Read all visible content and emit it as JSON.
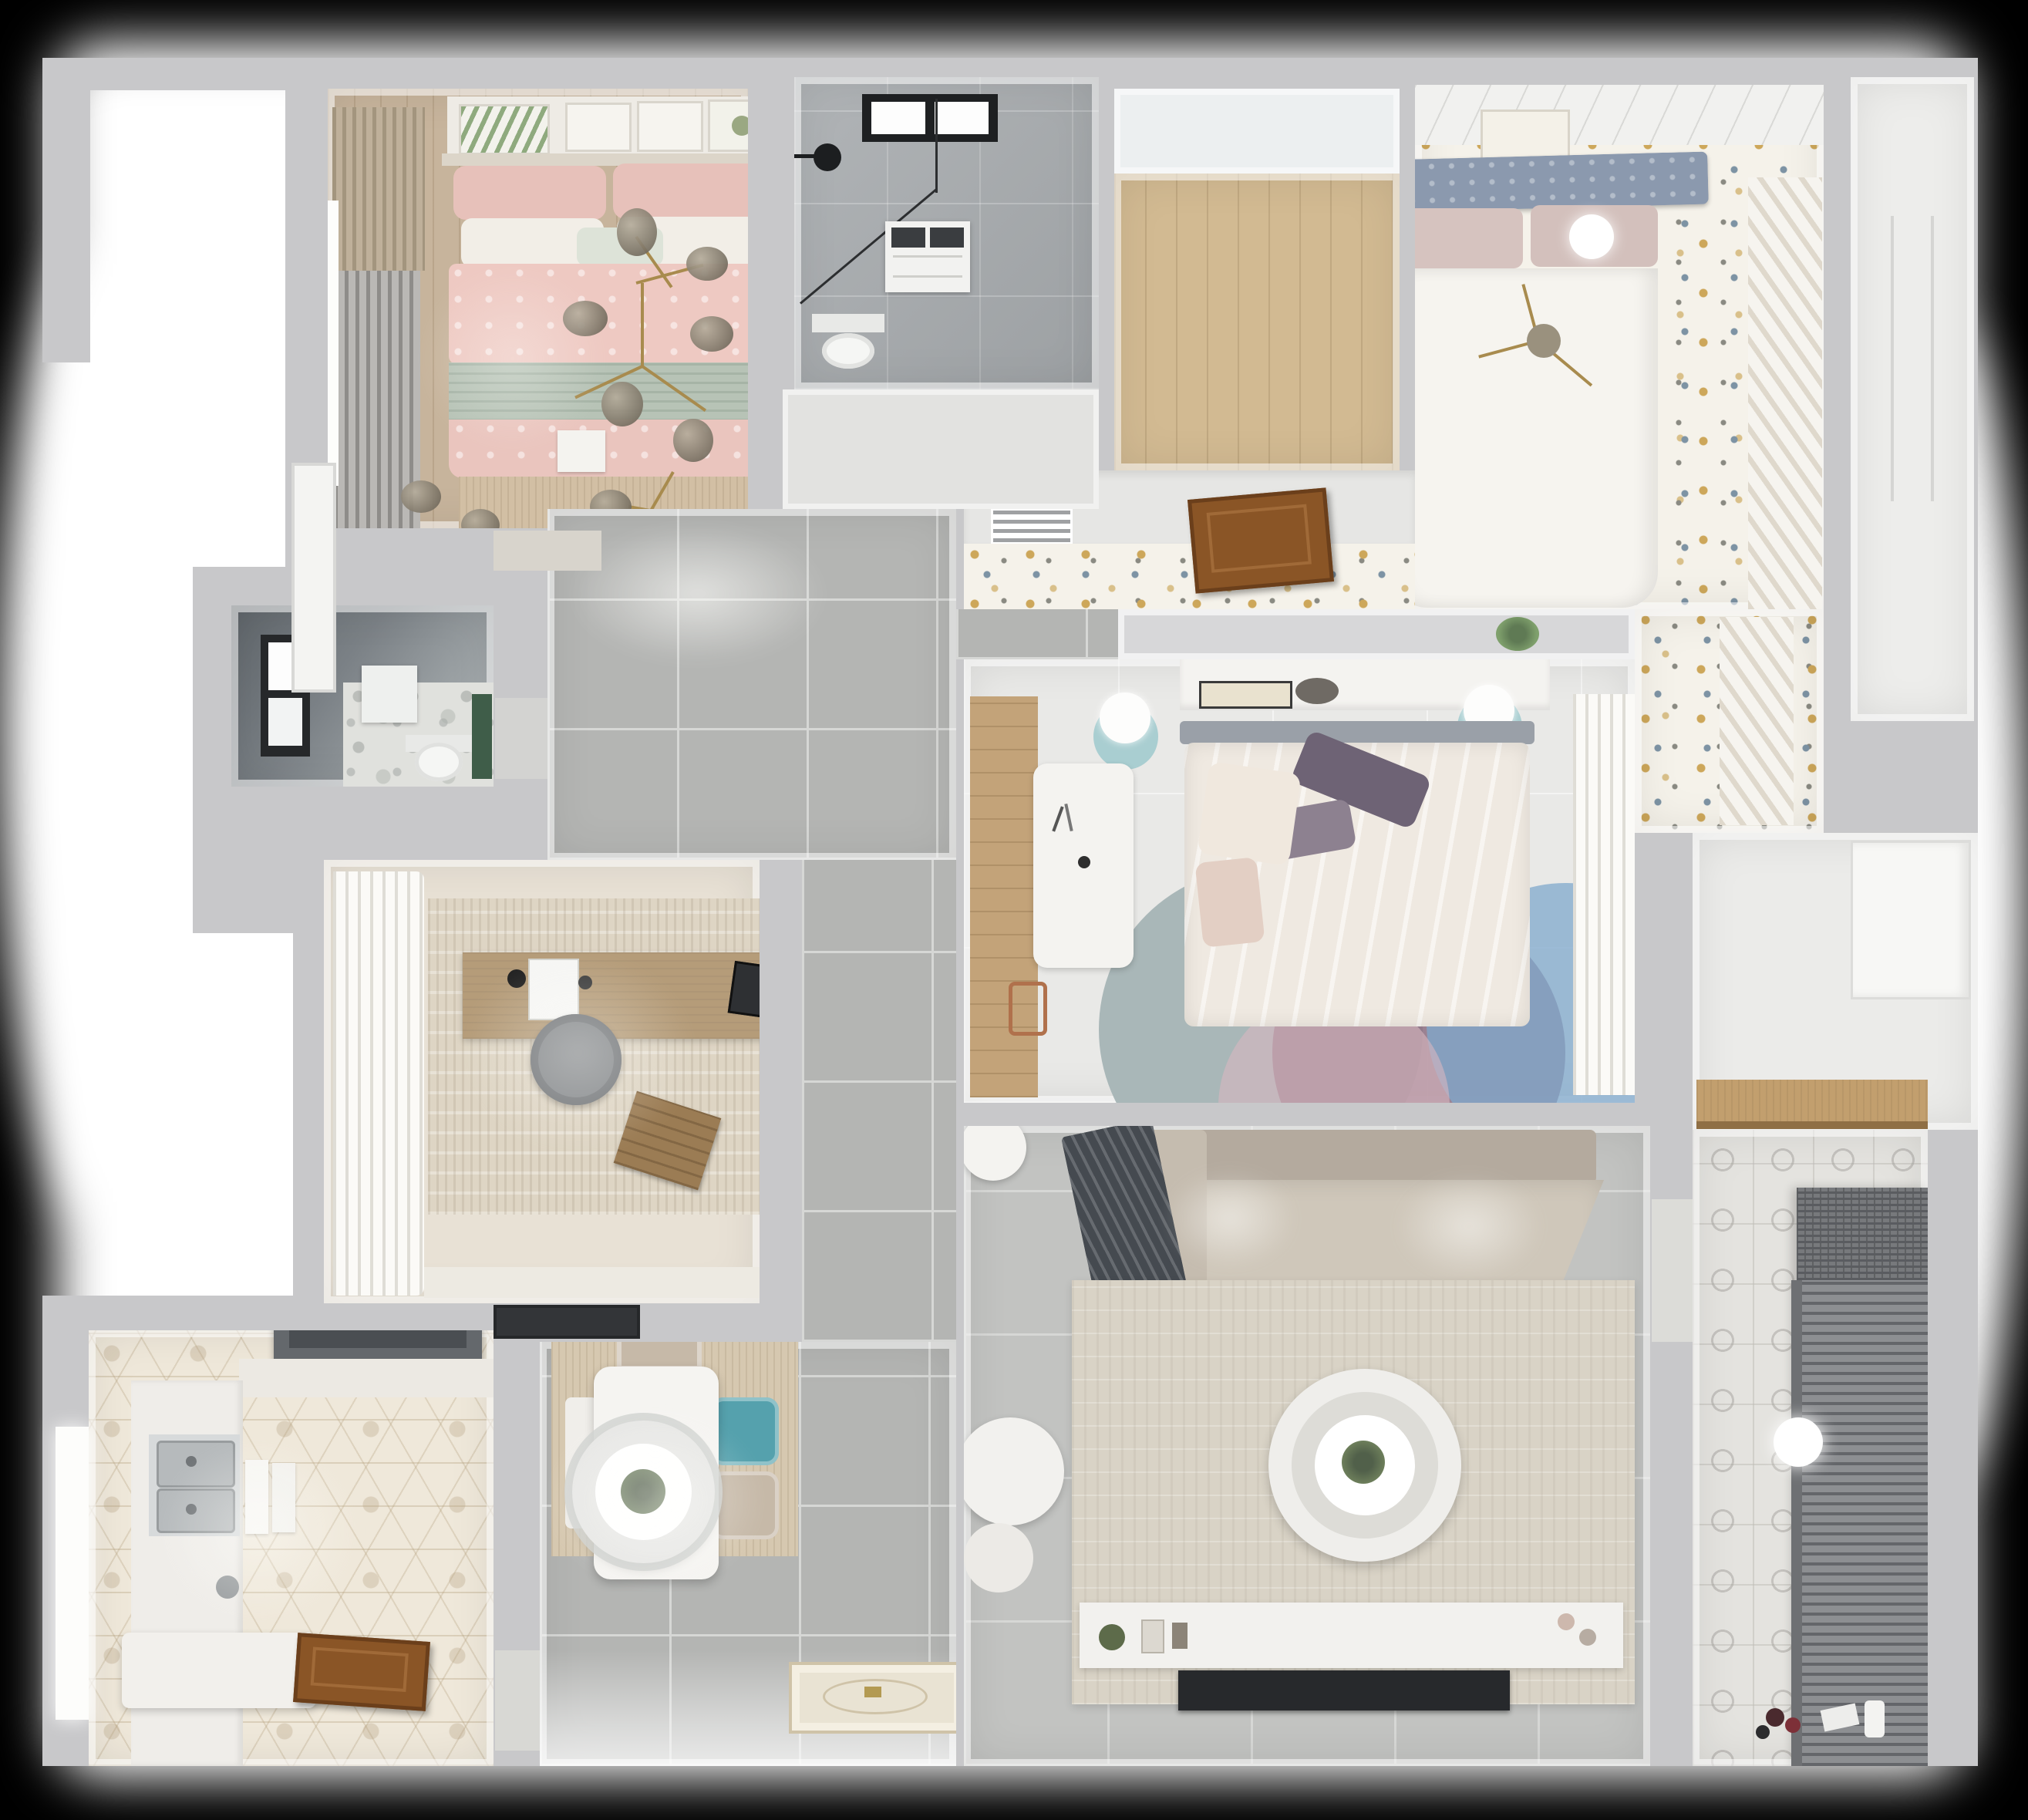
{
  "scene": {
    "title": "Apartment floor plan — top-down 3D render",
    "view": "bird's-eye cutaway",
    "visible_text": "none"
  },
  "palette": {
    "background": "#000000",
    "halo": "#ffffff",
    "wall": "#c8c8ca",
    "wallFace": "#ededee",
    "corridorTile": "#b4b5b3",
    "livingTile": "#c2c3c1",
    "masterWood": "#c7b49c",
    "closetWood": "#d2ba92",
    "wardrobeWood": "#c3a379",
    "marble": "#a6aaad",
    "dottedFloor": "#f5f2ea",
    "dotGold": "#cda75a",
    "dotBlue": "#7d93a4",
    "bedroom3Floor": "#e9e9e7",
    "terrazzo": "#e0e1dd",
    "hexTile": "#efe8da",
    "balconyTile": "#e4e3df",
    "pinkBedding": "#eec9c2",
    "sageBand": "#b7c3b6",
    "headboardBlue": "#8b99ae",
    "creamDuvet": "#efe9e1",
    "purplePillow": "#6e6375",
    "tealNightstand": "#a9ced1",
    "tealChair": "#55a1ad",
    "beigeChair": "#c6b9a8",
    "sofaBeige": "#cfc7ba",
    "throwGray": "#454a50",
    "rugLiving": "#d9d3c6",
    "rugOffice": "#ded5c4",
    "rugDining": "#d6c8b0",
    "rugMaster": "#d2bfa4",
    "tvBlack": "#27292c",
    "hoodGray": "#64686c",
    "steel": "#b6babc",
    "doorBrown": "#8a5526",
    "greenAccent": "#3f5d49",
    "gold": "#a88b4e",
    "blinds": "#85878a"
  },
  "rooms": [
    {
      "id": "master-bedroom",
      "label": "Master bedroom",
      "floor": "wood",
      "furniture": [
        "double-bed-pink-bedding",
        "pink-pillows",
        "white-pillows",
        "mint-cushion",
        "sage-runner",
        "gold-branch-chandelier",
        "gallery-frames",
        "gray-curtains",
        "tan-roman-shade",
        "window",
        "beige-rug",
        "white-tray"
      ]
    },
    {
      "id": "ensuite-bathroom",
      "label": "Bathroom 1",
      "floor": "gray-marble",
      "furniture": [
        "black-framed-window",
        "black-shower-head",
        "glass-shower-screen",
        "washing-machine",
        "toilet"
      ]
    },
    {
      "id": "closet-hall",
      "label": "Walk-in closet / hall",
      "floor": "light-oak",
      "furniture": []
    },
    {
      "id": "bedroom-2",
      "label": "Bedroom 2",
      "floor": "speckled-white",
      "furniture": [
        "double-bed-white-duvet",
        "blue-gray-tufted-headboard",
        "blush-pillows",
        "gold-sprig-lamp",
        "art-frame",
        "sheer-curtains",
        "ceiling-light"
      ]
    },
    {
      "id": "passage",
      "label": "Passage",
      "floor": "speckled-white",
      "furniture": [
        "ac-vent-grille",
        "open-wood-door"
      ]
    },
    {
      "id": "bedroom-3",
      "label": "Bedroom 3",
      "floor": "pale-tile",
      "furniture": [
        "bed-cream-duvet",
        "purple-pillows",
        "headboard-shelf-with-books",
        "teal-nightstands",
        "white-table-lamps",
        "white-desk",
        "wardrobe-wood-strip",
        "round-layered-rug",
        "sheer-curtains"
      ]
    },
    {
      "id": "living-room",
      "label": "Living room",
      "floor": "gray-tile",
      "furniture": [
        "l-shaped-beige-sofa",
        "dark-gray-throw",
        "large-beige-rug",
        "round-glass-coffee-table",
        "potted-plant",
        "white-armchair",
        "white-ottoman",
        "media-console",
        "flat-tv-panel",
        "side-stool"
      ]
    },
    {
      "id": "hallway",
      "label": "Hallway / entry",
      "floor": "gray-tile",
      "furniture": [
        "ornate-entry-mat"
      ]
    },
    {
      "id": "dining",
      "label": "Dining nook",
      "floor": "gray-tile-with-wood-rug",
      "furniture": [
        "white-dining-table",
        "round-pendant-lamp",
        "plant-centerpiece",
        "teal-chair",
        "two-beige-chairs",
        "white-bench"
      ]
    },
    {
      "id": "office",
      "label": "Study",
      "floor": "warm-tile",
      "furniture": [
        "wood-desk",
        "laptop",
        "desk-lamp",
        "tablet",
        "gray-swivel-chair",
        "wood-crate",
        "white-ruffle-curtains",
        "area-rug",
        "dark-doormat"
      ]
    },
    {
      "id": "small-bathroom",
      "label": "Bathroom 2",
      "floor": "terrazzo",
      "furniture": [
        "dark-tiled-shower-zone",
        "window",
        "black-shower-head",
        "shower-tray",
        "toilet",
        "green-shelf"
      ]
    },
    {
      "id": "kitchen",
      "label": "Kitchen",
      "floor": "hex-tile",
      "furniture": [
        "range-hood",
        "double-stainless-sink",
        "cutting-boards",
        "white-counters",
        "island-block",
        "open-wood-door",
        "window"
      ]
    },
    {
      "id": "storage",
      "label": "Storage niche",
      "floor": "white",
      "furniture": [
        "wood-shelf",
        "white-door"
      ]
    },
    {
      "id": "balcony",
      "label": "Balcony / laundry",
      "floor": "patterned-tile",
      "furniture": [
        "drying-rack-blinds",
        "ceiling-light",
        "toys",
        "bottles"
      ]
    },
    {
      "id": "service-strip",
      "label": "Side service strip",
      "floor": "white",
      "furniture": [
        "window-frame"
      ]
    }
  ]
}
